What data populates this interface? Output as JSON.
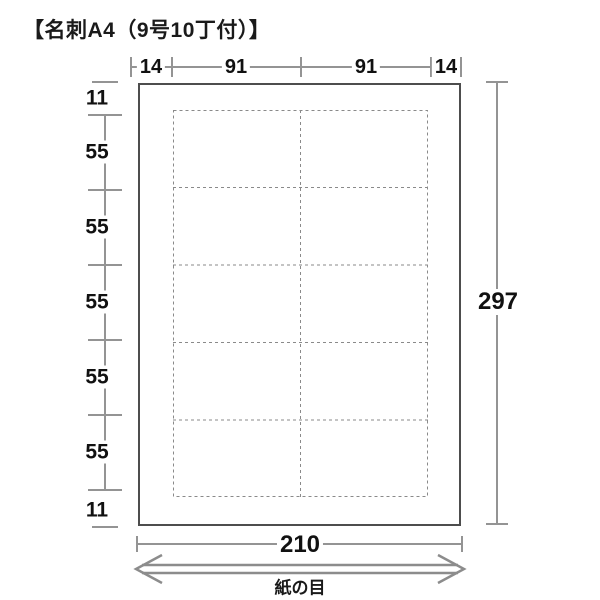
{
  "title": "【名刺A4（9号10丁付）】",
  "sheet": {
    "width_mm": "210",
    "height_mm": "297",
    "grain_label": "紙の目"
  },
  "dimensions": {
    "top": [
      "14",
      "91",
      "91",
      "14"
    ],
    "left": [
      "11",
      "55",
      "55",
      "55",
      "55",
      "55",
      "11"
    ],
    "right_total": "297",
    "bottom_total": "210"
  },
  "grid": {
    "columns": 2,
    "rows": 5
  },
  "colors": {
    "dimension_line": "#949494",
    "number_text": "#111111",
    "sheet_border": "#4d4d4d",
    "dashed_cut_line": "#8a8a8a"
  }
}
